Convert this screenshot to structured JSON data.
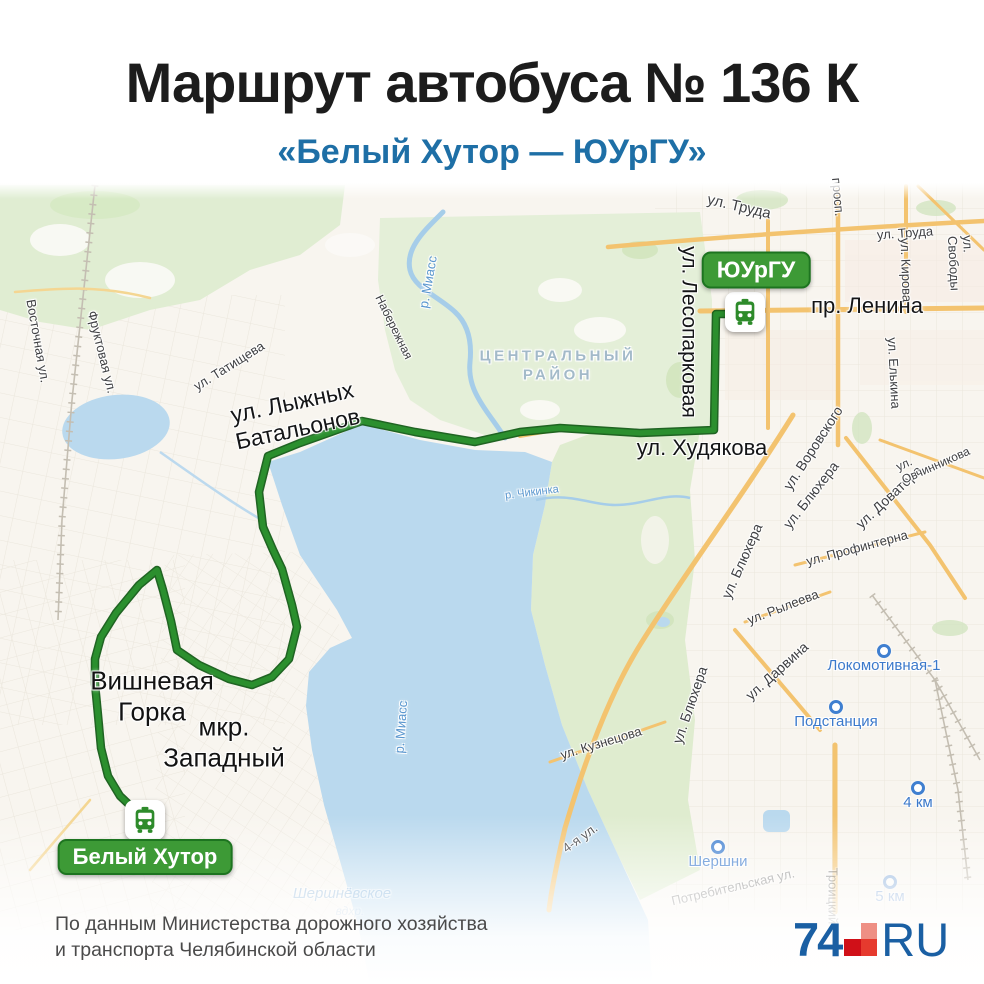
{
  "header": {
    "title": "Маршрут автобуса № 136 К",
    "subtitle": "«Белый Хутор — ЮУрГУ»"
  },
  "colors": {
    "subtitle_blue": "#1e6fa6",
    "route_green": "#1d7a21",
    "badge_green": "#3d9a36",
    "water_blue": "#bad9ee",
    "park_green": "#e4efd8",
    "station_blue": "#3b79cb",
    "road_orange": "#f3c36f",
    "logo_blue": "#1a5fa3",
    "logo_red": "#e63a2e"
  },
  "endpoints": {
    "end": {
      "label": "ЮУрГУ"
    },
    "start": {
      "label": "Белый Хутор"
    }
  },
  "map": {
    "labels": [
      {
        "text": "пр. Ленина",
        "x": 867,
        "y": 306,
        "rot": 0,
        "size": 22,
        "cls": "lbl-big"
      },
      {
        "text": "ул. Худякова",
        "x": 702,
        "y": 448,
        "rot": 0,
        "size": 22,
        "cls": "lbl-big"
      },
      {
        "text": "ул. Лесопарковая",
        "x": 688,
        "y": 332,
        "rot": 90,
        "size": 21,
        "cls": "lbl-big"
      },
      {
        "text": "ул. Лыжных\nБатальонов",
        "x": 295,
        "y": 416,
        "rot": -12,
        "size": 23,
        "cls": "lbl-big lbl-center"
      },
      {
        "text": "Вишневая\nГорка",
        "x": 152,
        "y": 696,
        "rot": 0,
        "size": 26,
        "cls": "lbl-place lbl-center"
      },
      {
        "text": "мкр.\nЗападный",
        "x": 224,
        "y": 742,
        "rot": 0,
        "size": 26,
        "cls": "lbl-place lbl-center"
      },
      {
        "text": "ЦЕНТРАЛЬНЫЙ\nРАЙОН",
        "x": 558,
        "y": 366,
        "rot": 0,
        "size": 15,
        "cls": "lbl-district lbl-center"
      },
      {
        "text": "ул. Труда",
        "x": 739,
        "y": 207,
        "rot": 13,
        "size": 15,
        "cls": "lbl-street"
      },
      {
        "text": "ул. Труда",
        "x": 905,
        "y": 233,
        "rot": -4,
        "size": 13,
        "cls": "lbl-street"
      },
      {
        "text": "ул. Свободы",
        "x": 961,
        "y": 263,
        "rot": 87,
        "size": 13,
        "cls": "lbl-street"
      },
      {
        "text": "ул. Кирова",
        "x": 906,
        "y": 270,
        "rot": 88,
        "size": 13,
        "cls": "lbl-street"
      },
      {
        "text": "просп.",
        "x": 838,
        "y": 197,
        "rot": 85,
        "size": 13,
        "cls": "lbl-street"
      },
      {
        "text": "ул. Елькина",
        "x": 894,
        "y": 373,
        "rot": 87,
        "size": 13,
        "cls": "lbl-street"
      },
      {
        "text": "ул. Воровского",
        "x": 813,
        "y": 448,
        "rot": -57,
        "size": 14,
        "cls": "lbl-street"
      },
      {
        "text": "ул. Блюхера",
        "x": 811,
        "y": 495,
        "rot": -52,
        "size": 14,
        "cls": "lbl-street"
      },
      {
        "text": "ул. Доватора",
        "x": 889,
        "y": 497,
        "rot": -43,
        "size": 14,
        "cls": "lbl-street"
      },
      {
        "text": "ул. Овчинникова",
        "x": 933,
        "y": 459,
        "rot": -24,
        "size": 12,
        "cls": "lbl-street"
      },
      {
        "text": "ул. Блюхера",
        "x": 742,
        "y": 561,
        "rot": -66,
        "size": 14,
        "cls": "lbl-street"
      },
      {
        "text": "ул. Профинтерна",
        "x": 857,
        "y": 548,
        "rot": -15,
        "size": 13,
        "cls": "lbl-street"
      },
      {
        "text": "ул. Рылеева",
        "x": 783,
        "y": 607,
        "rot": -21,
        "size": 13,
        "cls": "lbl-street"
      },
      {
        "text": "ул. Дарвина",
        "x": 777,
        "y": 671,
        "rot": -42,
        "size": 14,
        "cls": "lbl-street"
      },
      {
        "text": "ул. Блюхера",
        "x": 690,
        "y": 705,
        "rot": -71,
        "size": 14,
        "cls": "lbl-street"
      },
      {
        "text": "ул. Кузнецова",
        "x": 601,
        "y": 743,
        "rot": -17,
        "size": 13,
        "cls": "lbl-street"
      },
      {
        "text": "ул. Татищева",
        "x": 229,
        "y": 366,
        "rot": -32,
        "size": 13,
        "cls": "lbl-street"
      },
      {
        "text": "Восточная ул.",
        "x": 38,
        "y": 341,
        "rot": 80,
        "size": 13,
        "cls": "lbl-street"
      },
      {
        "text": "Фруктовая ул.",
        "x": 102,
        "y": 352,
        "rot": 76,
        "size": 13,
        "cls": "lbl-street"
      },
      {
        "text": "Набережная",
        "x": 394,
        "y": 327,
        "rot": 64,
        "size": 12,
        "cls": "lbl-street"
      },
      {
        "text": "4-я ул.",
        "x": 580,
        "y": 838,
        "rot": -36,
        "size": 13,
        "cls": "lbl-street"
      },
      {
        "text": "Потребительская ул.",
        "x": 733,
        "y": 887,
        "rot": -13,
        "size": 13,
        "cls": "lbl-street lbl-faded"
      },
      {
        "text": "Троицкий",
        "x": 833,
        "y": 896,
        "rot": 90,
        "size": 13,
        "cls": "lbl-street lbl-faded"
      },
      {
        "text": "р. Миасс",
        "x": 428,
        "y": 282,
        "rot": -80,
        "size": 13,
        "cls": "lbl-water"
      },
      {
        "text": "р. Миасс",
        "x": 401,
        "y": 727,
        "rot": -86,
        "size": 13,
        "cls": "lbl-water"
      },
      {
        "text": "р. Чикинка",
        "x": 532,
        "y": 493,
        "rot": -7,
        "size": 11,
        "cls": "lbl-water"
      },
      {
        "text": "Шершнёвское",
        "x": 342,
        "y": 894,
        "rot": 0,
        "size": 15,
        "cls": "lbl-water lbl-italic lbl-faded"
      },
      {
        "text": "вдхр.",
        "x": 350,
        "y": 911,
        "rot": 0,
        "size": 12,
        "cls": "lbl-water lbl-italic lbl-vfaded"
      }
    ],
    "stations": [
      {
        "label": "Локомотивная-1",
        "x": 884,
        "y": 651,
        "faded": false
      },
      {
        "label": "Подстанция",
        "x": 836,
        "y": 707,
        "faded": false
      },
      {
        "label": "Шершни",
        "x": 718,
        "y": 847,
        "faded": false
      },
      {
        "label": "4 км",
        "x": 918,
        "y": 788,
        "faded": false
      },
      {
        "label": "5 км",
        "x": 890,
        "y": 882,
        "faded": true
      }
    ]
  },
  "footer": {
    "source_line1": "По данным Министерства дорожного хозяйства",
    "source_line2": "и транспорта Челябинской области",
    "logo": {
      "part1": "74",
      "part2": "RU"
    }
  }
}
